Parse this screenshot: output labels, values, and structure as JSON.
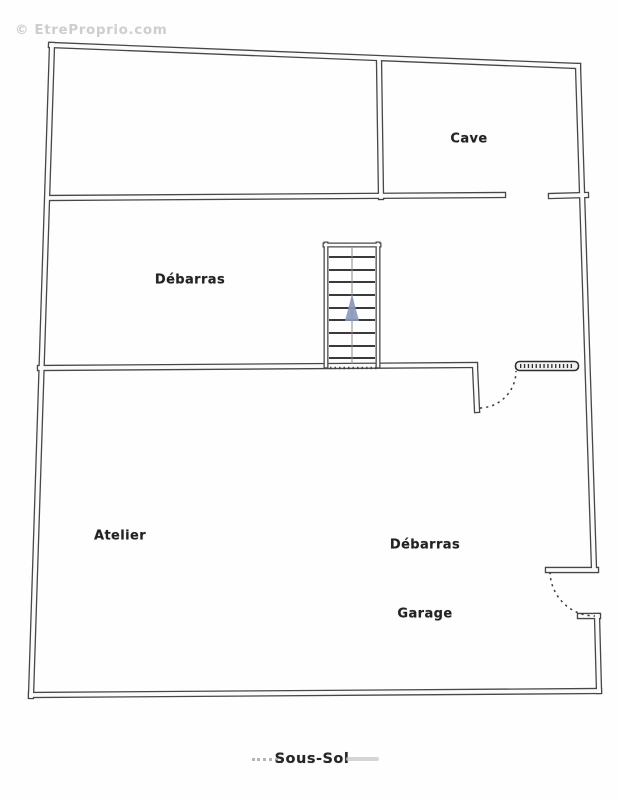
{
  "watermark": {
    "text": "© EtreProprio.com"
  },
  "plan": {
    "title": "Sous-Sol",
    "rooms": [
      {
        "id": "cave",
        "label": "Cave"
      },
      {
        "id": "debarras-upper",
        "label": "Débarras"
      },
      {
        "id": "atelier",
        "label": "Atelier"
      },
      {
        "id": "debarras-lower",
        "label": "Débarras"
      },
      {
        "id": "garage",
        "label": "Garage"
      }
    ],
    "icons": {
      "stairs_direction": "up-arrow",
      "doors": "swing-arc-dashed"
    },
    "colors": {
      "wall": "#474747",
      "stair_arrow": "#8a98ba",
      "watermark": "#cbd0cc",
      "label": "#222222"
    }
  }
}
